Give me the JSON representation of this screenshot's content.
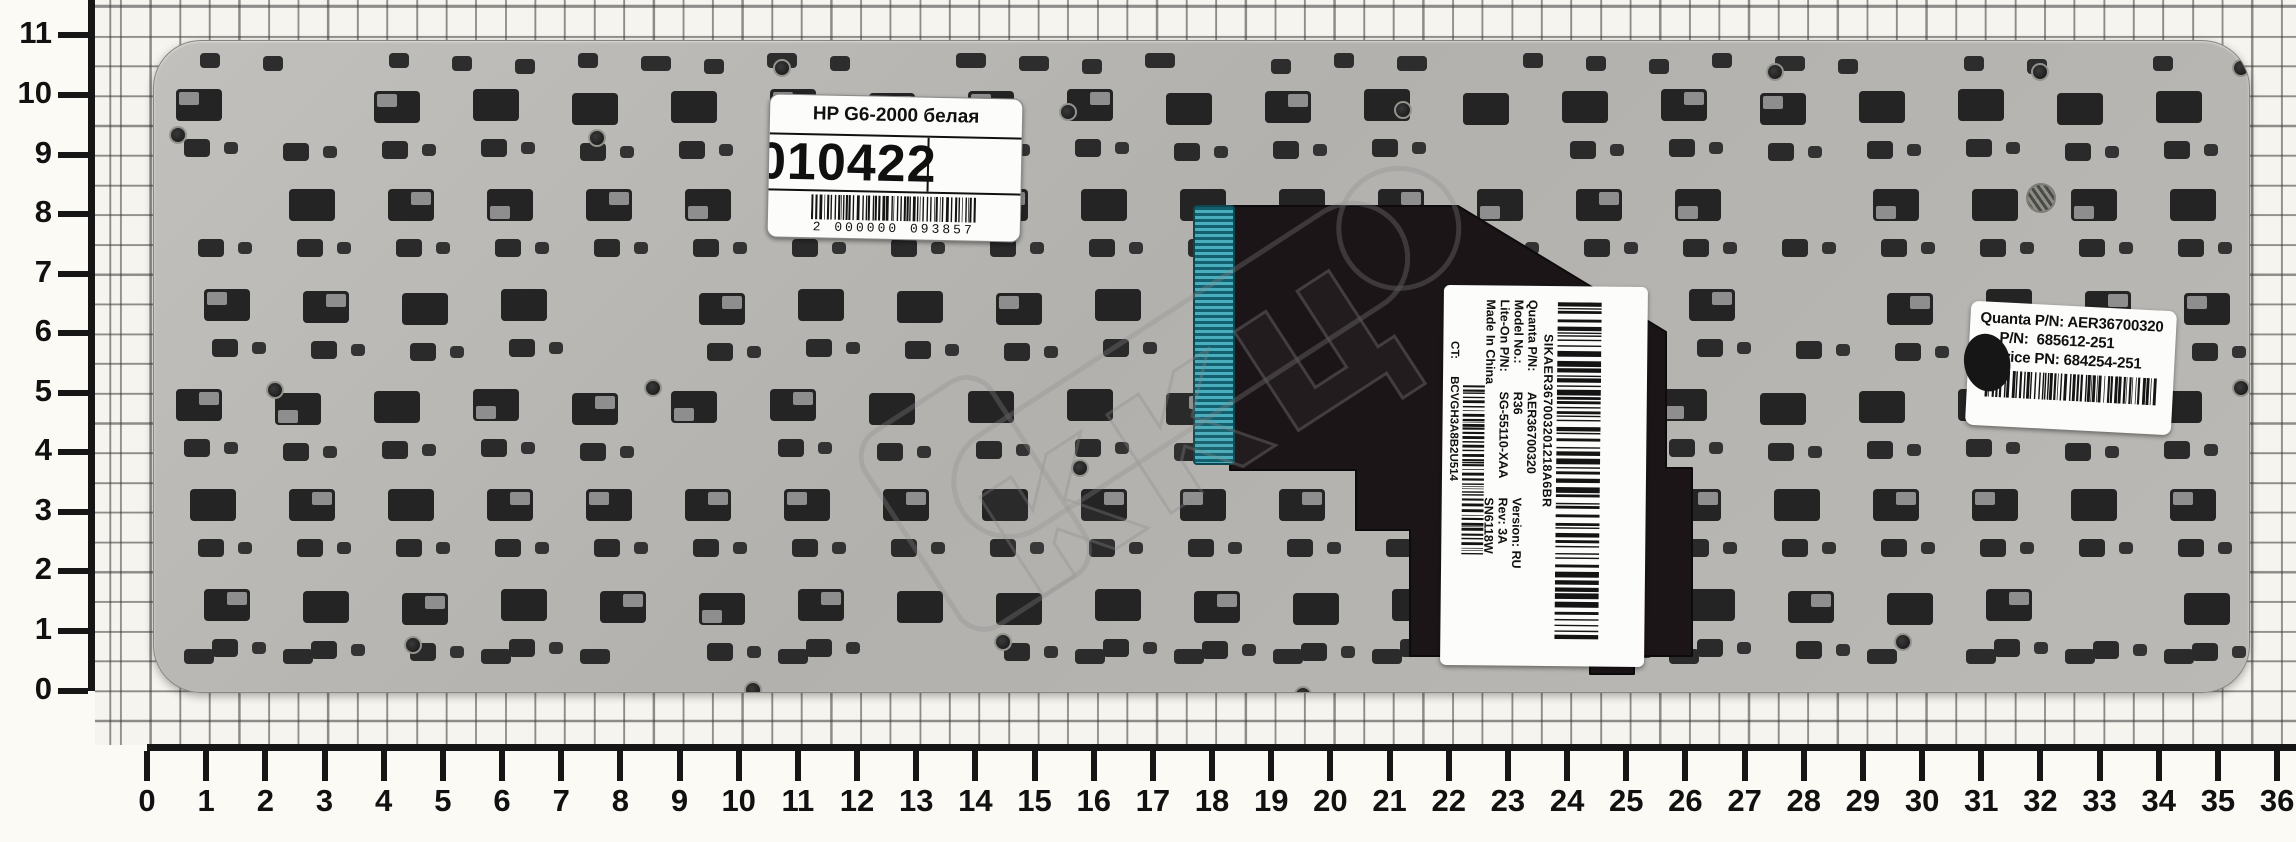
{
  "rulers": {
    "horizontal_labels": [
      "0",
      "1",
      "2",
      "3",
      "4",
      "5",
      "6",
      "7",
      "8",
      "9",
      "10",
      "11",
      "12",
      "13",
      "14",
      "15",
      "16",
      "17",
      "18",
      "19",
      "20",
      "21",
      "22",
      "23",
      "24",
      "25",
      "26",
      "27",
      "28",
      "29",
      "30",
      "31",
      "32",
      "33",
      "34",
      "35",
      "36"
    ],
    "vertical_labels": [
      "0",
      "1",
      "2",
      "3",
      "4",
      "5",
      "6",
      "7",
      "8",
      "9",
      "10",
      "11"
    ]
  },
  "shop_label": {
    "title": "HP G6-2000 белая",
    "code": "010422",
    "barcode_digits": "2 000000 093857"
  },
  "manufacturer_sticker": {
    "serial": "SIKAER367003201218A6BR",
    "rows": [
      {
        "label": "Quanta P/N:",
        "value": "AER36700320"
      },
      {
        "label": "Model No.:",
        "value": "R36"
      },
      {
        "label": "Lite-On P/N:",
        "value": "SG-55110-XAA"
      },
      {
        "label": "Made In China",
        "value": ""
      }
    ],
    "version": "Version:  RU",
    "rev": "Rev:  3A",
    "sn": "SN6118W",
    "ct_label": "CT:",
    "ct_value": "BCVGH3A8B2U514"
  },
  "hp_sticker": {
    "lines": [
      {
        "label": "Quanta P/N:",
        "value": "AER36700320"
      },
      {
        "label": "P/N:",
        "value": "685612-251"
      },
      {
        "label": "Service PN:",
        "value": "684254-251"
      }
    ]
  },
  "watermark": {
    "text": "ккц"
  },
  "colors": {
    "paper": "#f6f4ee",
    "grid_line": "#4a4a4a",
    "plate_gray": "#b7b5b1",
    "cutout_dark": "#242424",
    "cable_black": "#1c1518",
    "teal_connector": "#49aebd",
    "sticker_white": "#fcfcfa"
  }
}
